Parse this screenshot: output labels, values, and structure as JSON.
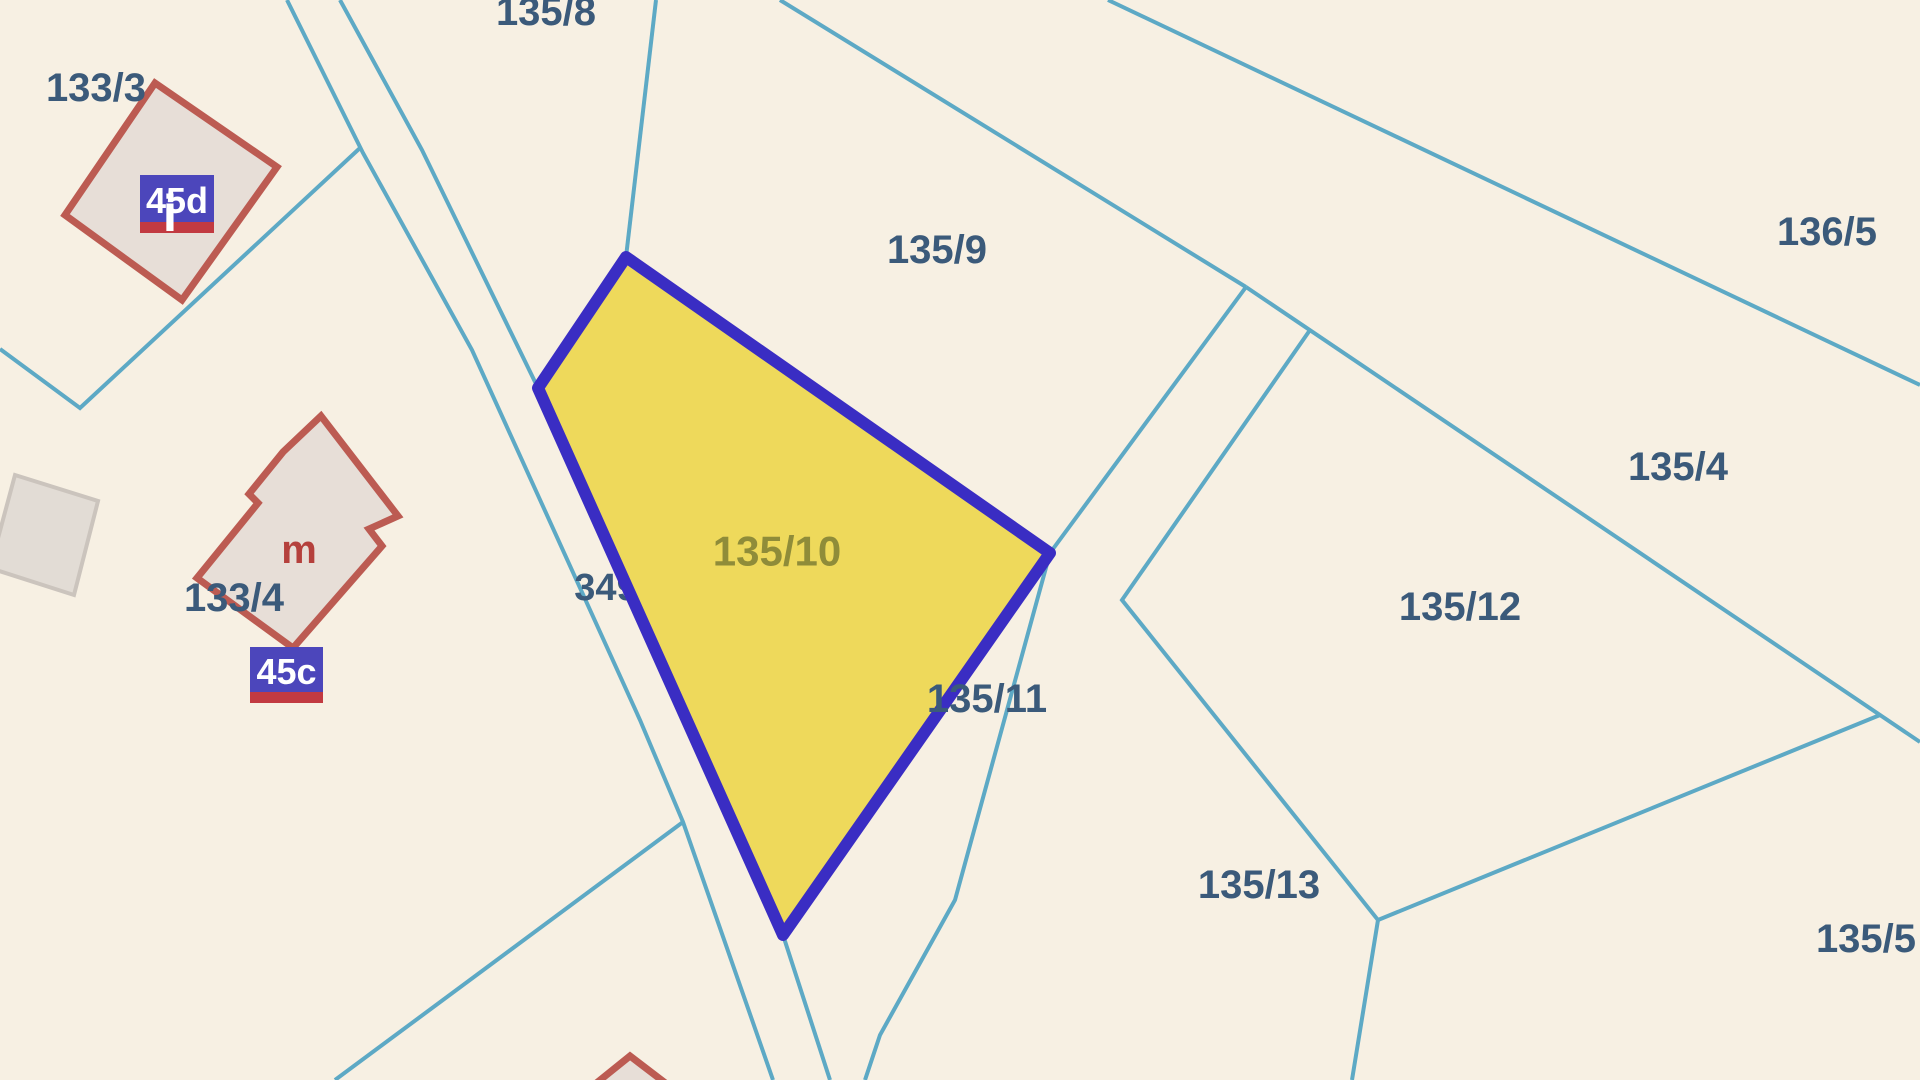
{
  "map": {
    "canvas": {
      "width": 1920,
      "height": 1080
    },
    "background_color": "#f7f0e3",
    "boundary_color": "#5da9c5",
    "boundary_width": 4,
    "label_color": "#3b5a7a",
    "boundary_lines": [
      {
        "name": "road-west-edge",
        "points": "287,0 363,153 472,350 640,720 683,822 773,1080"
      },
      {
        "name": "road-east-edge-north",
        "points": "340,0 422,150 538,388"
      },
      {
        "name": "road-east-edge-south",
        "points": "783,935 830,1080"
      },
      {
        "name": "parcel-133-3-south-boundary",
        "points": "0,349 80,408 360,148"
      },
      {
        "name": "boundary-135-8-135-9",
        "points": "656,0 626,257"
      },
      {
        "name": "boundary-135-9-north",
        "points": "780,0 1246,287"
      },
      {
        "name": "boundary-136-5-135-4",
        "points": "1108,0 1920,385"
      },
      {
        "name": "boundary-135-9-east",
        "points": "1246,287 1050,553"
      },
      {
        "name": "boundary-135-12-west",
        "points": "1310,330 1122,600 1378,920 1352,1080"
      },
      {
        "name": "boundary-135-4-south",
        "points": "1246,287 1920,742"
      },
      {
        "name": "boundary-135-5-west",
        "points": "1880,715 1378,920"
      },
      {
        "name": "boundary-135-11-east",
        "points": "1050,553 955,900 880,1035 865,1080"
      },
      {
        "name": "boundary-southwest-branch",
        "points": "683,822 335,1080"
      }
    ],
    "buildings": [
      {
        "name": "building-45d",
        "fill": "#e7ded7",
        "stroke": "#bc5b52",
        "stroke_width": 7,
        "points": "155,83 277,167 182,300 65,215"
      },
      {
        "name": "building-45c-m",
        "fill": "#e7ded7",
        "stroke": "#bc5b52",
        "stroke_width": 7,
        "points": "321,416 398,516 369,529 382,546 293,648 197,578 258,503 249,494 283,452"
      },
      {
        "name": "building-grey",
        "fill": "#e2dcd5",
        "stroke": "#cbc4bd",
        "stroke_width": 4,
        "points": "15,475 98,501 74,595 -10,568"
      },
      {
        "name": "building-south-partial",
        "fill": "#e7ded7",
        "stroke": "#bc5b52",
        "stroke_width": 7,
        "points": "630,1056 594,1085 668,1085"
      }
    ],
    "highlight_parcel": {
      "name": "parcel-135-10-highlight",
      "parcel_number": "135/10",
      "fill": "#eed95b",
      "stroke": "#3a2dc3",
      "stroke_width": 12,
      "points": "626,257 1050,553 783,935 538,388"
    },
    "labels_under": [
      {
        "name": "label-349",
        "text": "349",
        "x": 606,
        "y": 588,
        "size": 38,
        "color": "#3b5a7a"
      }
    ],
    "labels": [
      {
        "name": "label-133-3",
        "text": "133/3",
        "x": 96,
        "y": 88,
        "size": 40,
        "color": "#3b5a7a"
      },
      {
        "name": "label-135-8",
        "text": "135/8",
        "x": 546,
        "y": 12,
        "size": 40,
        "color": "#3b5a7a"
      },
      {
        "name": "label-135-9",
        "text": "135/9",
        "x": 937,
        "y": 250,
        "size": 40,
        "color": "#3b5a7a"
      },
      {
        "name": "label-136-5",
        "text": "136/5",
        "x": 1827,
        "y": 232,
        "size": 40,
        "color": "#3b5a7a"
      },
      {
        "name": "label-135-4",
        "text": "135/4",
        "x": 1678,
        "y": 467,
        "size": 40,
        "color": "#3b5a7a"
      },
      {
        "name": "label-135-12",
        "text": "135/12",
        "x": 1460,
        "y": 607,
        "size": 40,
        "color": "#3b5a7a"
      },
      {
        "name": "label-135-11",
        "text": "135/11",
        "x": 987,
        "y": 699,
        "size": 40,
        "color": "#3b5a7a"
      },
      {
        "name": "label-135-13",
        "text": "135/13",
        "x": 1259,
        "y": 885,
        "size": 40,
        "color": "#3b5a7a"
      },
      {
        "name": "label-135-5",
        "text": "135/5",
        "x": 1866,
        "y": 939,
        "size": 40,
        "color": "#3b5a7a"
      },
      {
        "name": "label-133-4",
        "text": "133/4",
        "x": 234,
        "y": 598,
        "size": 40,
        "color": "#3b5a7a"
      },
      {
        "name": "label-135-10",
        "text": "135/10",
        "x": 777,
        "y": 551,
        "size": 42,
        "color": "#8f8c39"
      },
      {
        "name": "label-m",
        "text": "m",
        "x": 299,
        "y": 550,
        "size": 40,
        "color": "#b5403c"
      }
    ],
    "address_badges": [
      {
        "name": "badge-45d",
        "label": "45d",
        "x": 140,
        "y": 175,
        "width": 74,
        "height": 47,
        "strip_height": 11,
        "box_color": "#4c46bb",
        "strip_color": "#c23a41",
        "text_color": "#ffffff",
        "size": 36,
        "marker": {
          "glyph": "i",
          "x": 170,
          "y": 214,
          "size": 52,
          "color": "#ffffff"
        }
      },
      {
        "name": "badge-45c",
        "label": "45c",
        "x": 250,
        "y": 647,
        "width": 73,
        "height": 45,
        "strip_height": 11,
        "box_color": "#4c46bb",
        "strip_color": "#c23a41",
        "text_color": "#ffffff",
        "size": 36,
        "marker": null
      }
    ]
  }
}
